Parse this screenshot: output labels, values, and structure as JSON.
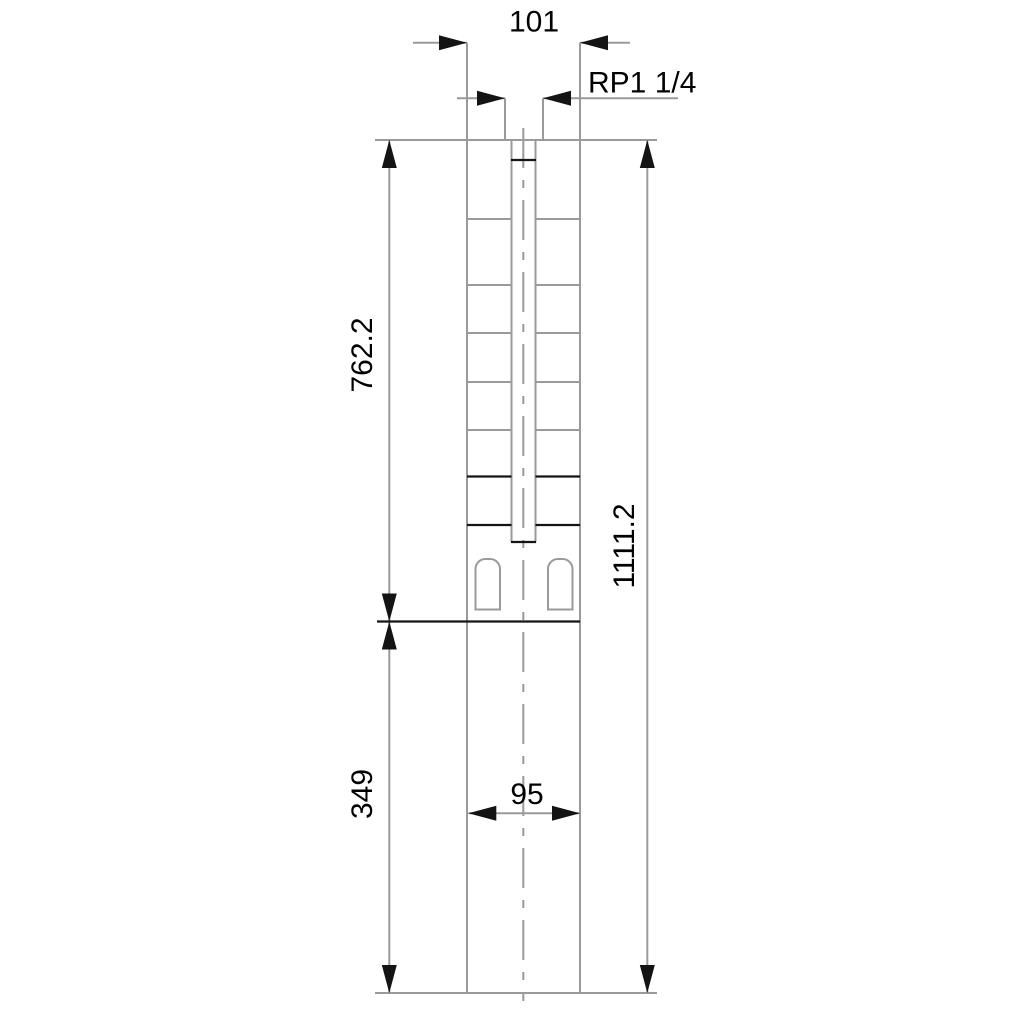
{
  "colors": {
    "background": "#ffffff",
    "line_gray": "#9a9a9a",
    "line_black": "#141414",
    "arrow_black": "#141414",
    "text": "#000000"
  },
  "dimensions": {
    "top_width": "101",
    "thread_size": "RP1 1/4",
    "upper_section_length": "762.2",
    "lower_section_length": "349",
    "total_length": "1111.2",
    "lower_width": "95"
  }
}
